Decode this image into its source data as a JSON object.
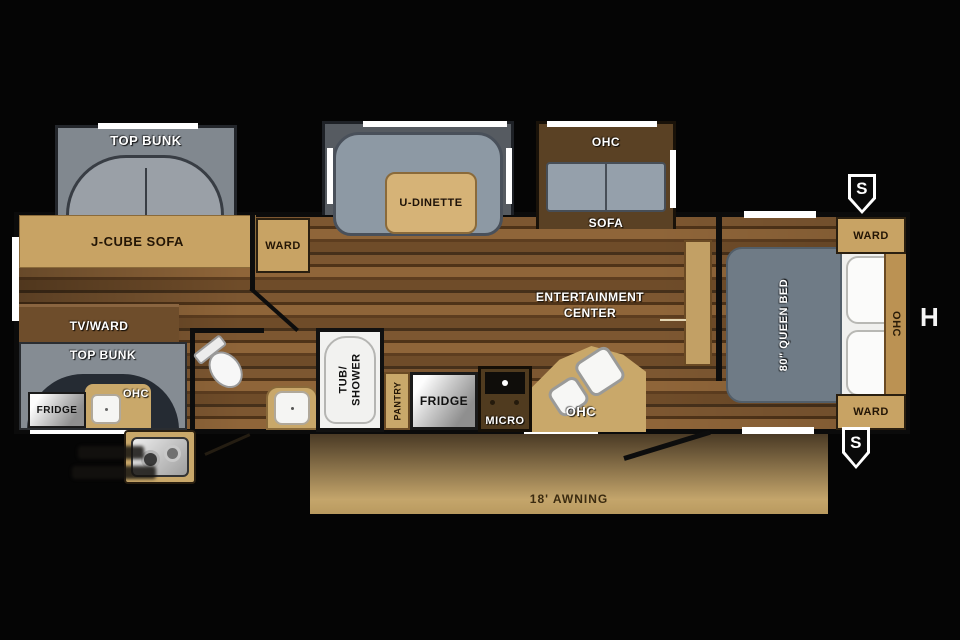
{
  "floorplan": {
    "front_bunk": {
      "label": "TOP BUNK"
    },
    "living": {
      "j_cube_sofa": "J-CUBE SOFA",
      "ward": "WARD",
      "tv_ward": "TV/WARD",
      "dinette": "U-DINETTE",
      "sofa_ohc": "OHC",
      "sofa": "SOFA"
    },
    "rear_bunk": {
      "label": "TOP BUNK",
      "fridge": "FRIDGE",
      "ohc": "OHC"
    },
    "bath": {
      "tub_line1": "TUB/",
      "tub_line2": "SHOWER"
    },
    "kitchen": {
      "pantry": "PANTRY",
      "fridge": "FRIDGE",
      "micro": "MICRO",
      "ohc": "OHC"
    },
    "entertainment": {
      "line1": "ENTERTAINMENT",
      "line2": "CENTER"
    },
    "bedroom": {
      "bed": "80\" QUEEN BED",
      "ward_top": "WARD",
      "ward_bottom": "WARD",
      "ohc": "OHC"
    },
    "exterior": {
      "awning": "18' AWNING",
      "speaker_top": "S",
      "speaker_bottom": "S",
      "height_marker": "H"
    }
  },
  "colors": {
    "background": "#050505",
    "wall_black": "#0d0d0d",
    "wood_light": "#8f6539",
    "wood_dark": "#4f3318",
    "cabinet_tan": "#c8a364",
    "cabinet_dark_brown": "#5a4124",
    "upholstery_gray": "#8d99a4",
    "bunk_gray": "#858c93",
    "bed_gray": "#6f7b86",
    "window_white": "#ffffff",
    "awning_tan": "#c4a56b"
  }
}
